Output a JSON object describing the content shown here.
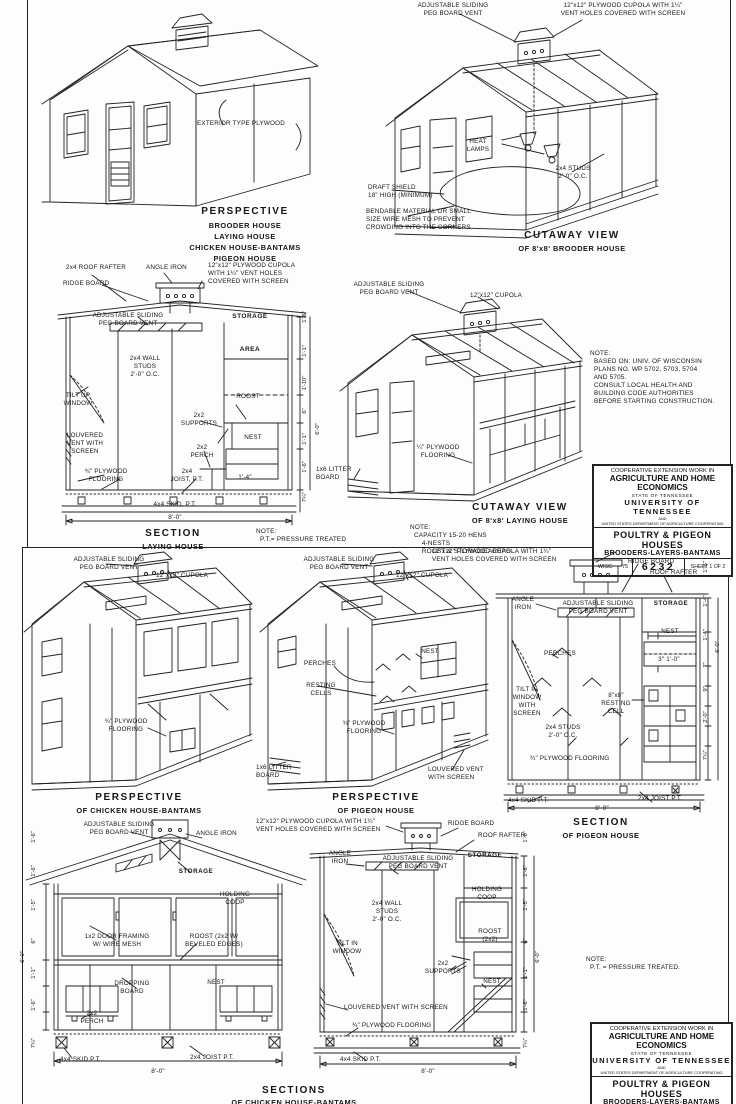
{
  "titleblock": {
    "l1": "COOPERATIVE EXTENSION WORK IN",
    "l2": "AGRICULTURE AND HOME ECONOMICS",
    "l3": "STATE OF TENNESSEE",
    "l4": "UNIVERSITY OF TENNESSEE",
    "l5": "AND",
    "l6": "UNITED STATES DEPARTMENT OF AGRICULTURE COOPERATING",
    "l7": "POULTRY & PIGEON HOUSES",
    "l8": "BROODERS-LAYERS-BANTAMS",
    "wisc": "WISC.",
    "year": "'75",
    "number": "6232",
    "sheet1": "SHEET 1 OF 2",
    "sheet2": "SHEET 2 OF 2"
  },
  "sheet1": {
    "persp": {
      "wall": "EXTERIOR TYPE PLYWOOD",
      "title": "PERSPECTIVE",
      "subs": [
        "BROODER HOUSE",
        "LAYING HOUSE",
        "CHICKEN HOUSE-BANTAMS",
        "PIGEON HOUSE"
      ]
    },
    "brooder": {
      "peg_vent": "ADJUSTABLE SLIDING\nPEG BOARD VENT",
      "cupola": "12\"x12\" PLYWOOD CUPOLA WITH 1¼\"\nVENT HOLES COVERED WITH SCREEN",
      "heat": "HEAT\nLAMPS",
      "studs": "2x4 STUDS\n2'-0\" O.C.",
      "draft": "DRAFT SHIELD\n18\" HIGH (MINIMUM)",
      "bendable": "BENDABLE MATERIAL OR SMALL\nSIZE WIRE MESH TO PREVENT\nCROWDING INTO THE CORNERS",
      "title": "CUTAWAY VIEW",
      "subtitle": "OF 8'x8' BROODER HOUSE"
    },
    "laying_section": {
      "rafter": "2x4 ROOF RAFTER",
      "angle": "ANGLE IRON",
      "ridge": "RIDGE BOARD",
      "cupola": "12\"x12\" PLYWOOD CUPOLA\nWITH 1¼\" VENT HOLES\nCOVERED WITH SCREEN",
      "peg_vent": "ADJUSTABLE SLIDING\nPEG BOARD VENT",
      "storage": "STORAGE",
      "area": "AREA",
      "studs": "2x4 WALL\nSTUDS\n2'-0\" O.C.",
      "tilt": "TILT UP\nWINDOW",
      "roost": "ROOST",
      "louver": "LOUVERED\nVENT WITH\nSCREEN",
      "supports": "2x2\nSUPPORTS",
      "nest": "NEST",
      "perch": "2x2\nPERCH",
      "floor": "¾\" PLYWOOD\nFLOORING",
      "joist": "2x4\nJOIST, P.T.",
      "dim14": "1'-4\"",
      "skid": "4x4 SKID, P.T.",
      "dim80": "8'-0\"",
      "title": "SECTION",
      "subtitle": "LAYING HOUSE",
      "dims": [
        "1'-6\"",
        "1'-1\"",
        "1'-10\"",
        "6'-0\"",
        "6\"",
        "1'-1\"",
        "1'-6\"",
        "7¼\""
      ]
    },
    "note_pt": "NOTE:\n  P.T.= PRESSURE TREATED",
    "laying_cutaway": {
      "peg_vent": "ADJUSTABLE SLIDING\nPEG BOARD VENT",
      "cupola": "12\"x12\" CUPOLA",
      "litter": "1x6 LITTER\nBOARD",
      "floor": "¼\" PLYWOOD\nFLOORING",
      "title": "CUTAWAY VIEW",
      "subtitle": "OF 8'x8' LAYING HOUSE",
      "note": "NOTE:\n  CAPACITY 15-20 HENS\n      4-NESTS\n      ROOST & STORAGE AREAS."
    },
    "note_wisc": "NOTE:\n  BASED ON: UNIV. OF WISCONSIN\n  PLANS NO. WP 5702, 5703, 5704\n  AND 5705.\n  CONSULT LOCAL HEALTH AND\n  BUILDING CODE AUTHORITIES\n  BEFORE STARTING CONSTRUCTION."
  },
  "sheet2": {
    "chicken_persp": {
      "peg_vent": "ADJUSTABLE SLIDING\nPEG BOARD VENT",
      "cupola": "12\"x12\" CUPOLA",
      "floor": "¾\" PLYWOOD\nFLOORING",
      "title": "PERSPECTIVE",
      "subtitle": "OF CHICKEN HOUSE-BANTAMS"
    },
    "pigeon_persp": {
      "peg_vent": "ADJUSTABLE SLIDING\nPEG BOARD VENT",
      "cupola": "12\"x12\" CUPOLA",
      "perches": "PERCHES",
      "resting": "RESTING\nCELLS",
      "nest": "NEST",
      "floor": "¾\" PLYWOOD\nFLOORING",
      "litter": "1x6 LITTER\nBOARD",
      "louver": "LOUVERED VENT\nWITH SCREEN",
      "title": "PERSPECTIVE",
      "subtitle": "OF PIGEON HOUSE"
    },
    "pigeon_section": {
      "cupola": "12\"x12\" PLYWOOD CUPOLA WITH 1¼\"\nVENT HOLES COVERED WITH SCREEN",
      "ridge": "RIDGE BOARD",
      "rafter": "ROOF RAFTER",
      "angle": "ANGLE\nIRON",
      "peg_vent": "ADJUSTABLE SLIDING\nPEG BOARD VENT",
      "storage": "STORAGE",
      "nest": "NEST",
      "dim31": "3\"  1'-0\"",
      "perches": "PERCHES",
      "tilt": "TILT IN\nWINDOW\nWITH\nSCREEN",
      "cell": "8\"x8\"\nRESTING\nCELL",
      "studs": "2x4 STUDS\n2'-0\" O.C.",
      "floor": "¾\" PLYWOOD FLOORING",
      "skid": "4x4 SKID P.T.",
      "joist": "2x4 JOIST P.T.",
      "dim80": "8'-0\"",
      "title": "SECTION",
      "subtitle": "OF PIGEON HOUSE",
      "dims": [
        "1'-6\"",
        "1'-4\"",
        "1'-4\"",
        "7\"",
        "9\"",
        "2'-0\"",
        "7¼\"",
        "6'-0\""
      ]
    },
    "chicken_a": {
      "peg_vent": "ADJUSTABLE SLIDING\nPEG BOARD VENT",
      "angle": "ANGLE IRON",
      "storage": "STORAGE",
      "coop": "HOLDING\nCOOP",
      "door": "1x2 DOOR FRAMING\nW/ WIRE MESH",
      "roost": "ROOST (2x2 W/\nBEVELED EDGES)",
      "dropping": "DROPPING\nBOARD",
      "nest": "NEST",
      "perch": "2x2\nPERCH",
      "skid": "4x4 SKID P.T.",
      "joist": "2x4 JOIST P.T.",
      "dim80": "8'-0\"",
      "dims": [
        "1'-6\"",
        "1'-6\"",
        "1'-5\"",
        "6'-0\"",
        "6\"",
        "1'-1\"",
        "1'-6\"",
        "7¼\""
      ]
    },
    "chicken_b": {
      "cupola": "12\"x12\" PLYWOOD CUPOLA WITH 1¼\"\nVENT HOLES COVERED WITH SCREEN",
      "ridge": "RIDGE BOARD",
      "rafter": "ROOF RAFTER",
      "angle": "ANGLE\nIRON",
      "peg_vent": "ADJUSTABLE SLIDING\nPEG BOARD VENT",
      "storage": "STORAGE",
      "coop": "HOLDING\nCOOP",
      "studs": "2x4 WALL\nSTUDS\n2'-0\" O.C.",
      "tilt": "TILT IN\nWINDOW",
      "roost": "ROOST\n(2x2)",
      "supports": "2x2\nSUPPORTS",
      "nest": "NEST",
      "louver": "LOUVERED VENT WITH SCREEN",
      "floor": "¾\" PLYWOOD FLOORING",
      "skid": "4x4 SKID P.T.",
      "dim80": "8'-0\"",
      "dims": [
        "1'-6\"",
        "1'-6\"",
        "1'-5\"",
        "6'-0\"",
        "6\"",
        "1'-1\"",
        "1'-6\"",
        "7¼\""
      ]
    },
    "sections_title": "SECTIONS",
    "sections_subtitle": "OF CHICKEN HOUSE-BANTAMS",
    "note_pt": "NOTE:\n  P.T. = PRESSURE TREATED."
  }
}
